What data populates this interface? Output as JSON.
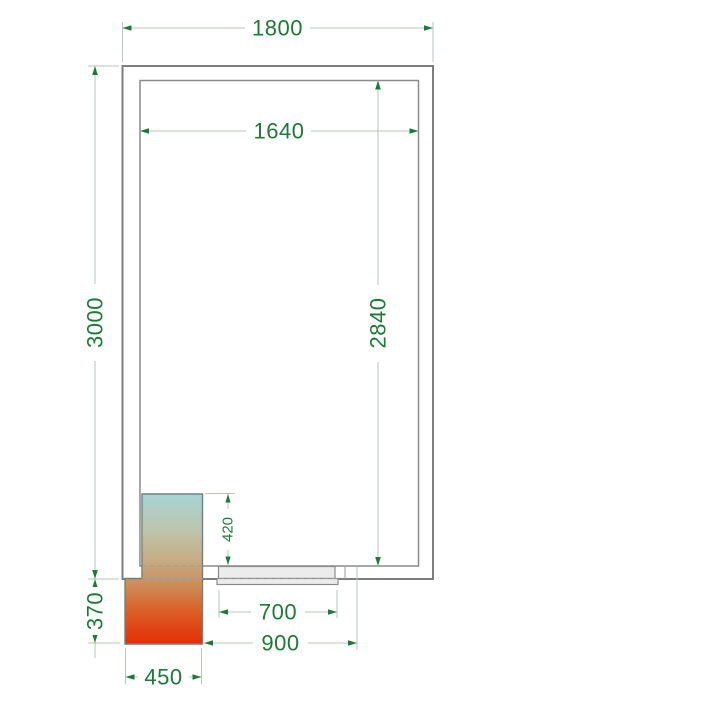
{
  "drawing": {
    "title": "Cold room floor plan with cooling unit and door",
    "units": "mm",
    "dimensions": {
      "outer_width": "1800",
      "inner_width": "1640",
      "outer_length": "3000",
      "inner_length": "2840",
      "unit_inside_protrusion": "420",
      "unit_outside_protrusion": "370",
      "door_width": "700",
      "door_span": "900",
      "unit_width": "450"
    },
    "colors": {
      "dim_text": "#1c7a36",
      "dim_arrow": "#1c7a36",
      "dim_line": "#b7c6b7",
      "wall_line": "#7e7e7e",
      "door_fill": "#ececec",
      "unit_gradient_top": "#a8d4d6",
      "unit_gradient_mid": "#c6ab82",
      "unit_gradient_bottom": "#e42f06",
      "background": "#ffffff"
    }
  }
}
